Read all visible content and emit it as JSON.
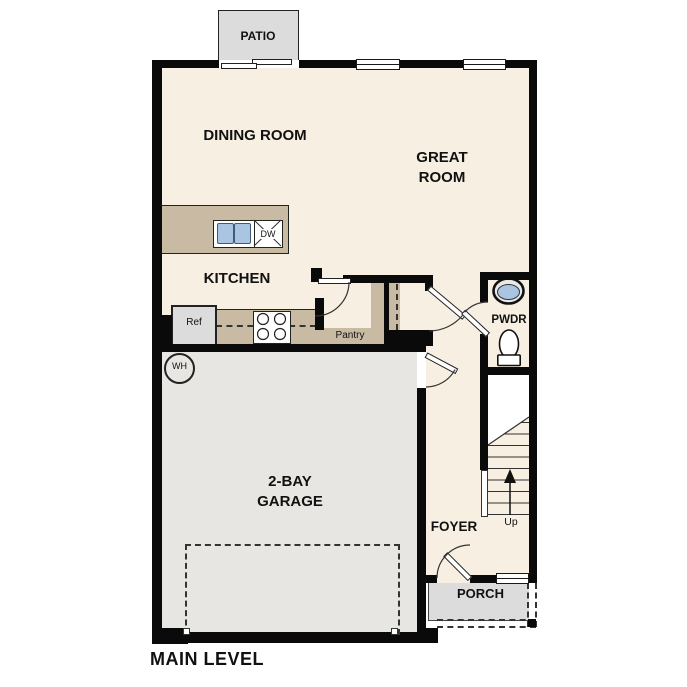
{
  "title": "MAIN LEVEL",
  "rooms": {
    "patio": "PATIO",
    "dining_room": "DINING ROOM",
    "great_room": "GREAT ROOM",
    "kitchen": "KITCHEN",
    "powder_room": "PWDR",
    "pantry": "Pantry",
    "garage": "2-BAY GARAGE",
    "foyer": "FOYER",
    "porch": "PORCH"
  },
  "labels": {
    "refrigerator": "Ref",
    "dishwasher": "DW",
    "water_heater": "WH",
    "stairs_direction": "Up"
  },
  "icons": [
    "island-sink",
    "dishwasher-x",
    "stove-burners",
    "pwdr-sink",
    "toilet",
    "stairs",
    "up-arrow",
    "water-heater-circle",
    "garage-door-dashed",
    "door-arc",
    "door-leaf",
    "window",
    "sliding-door"
  ],
  "colors": {
    "floor": "#f7efe1",
    "cabinet_tan": "#c9bba3",
    "concrete_gray": "#dcdcdc",
    "garage_gray": "#e7e6e2",
    "sink_blue": "#a9c5e2",
    "wall_black": "#0a0a0a"
  }
}
